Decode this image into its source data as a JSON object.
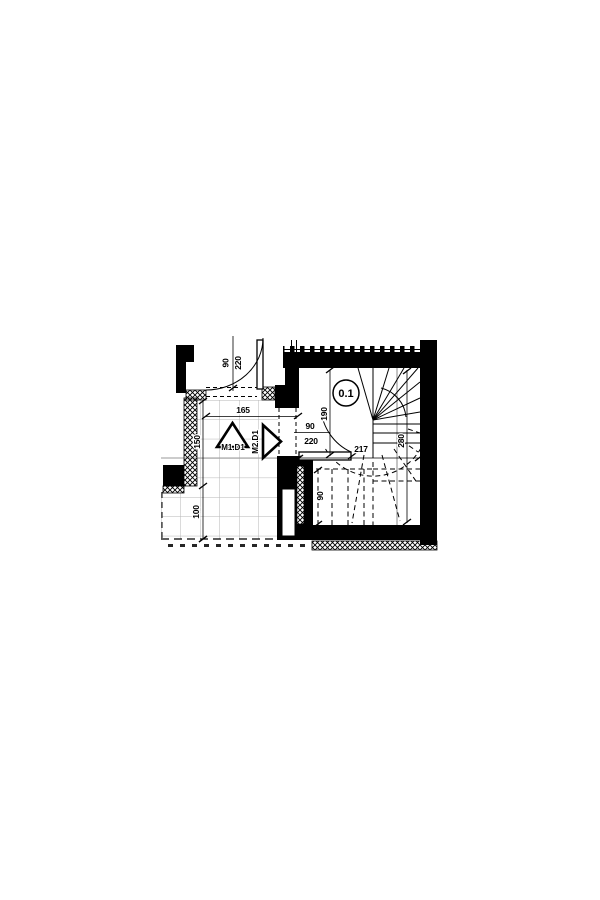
{
  "plan": {
    "room_label": "0.1",
    "doors": {
      "top": {
        "width": "90",
        "height": "220"
      },
      "stair": {
        "width": "90",
        "height": "220"
      }
    },
    "dims": {
      "hall_door_span": "165",
      "hall_upper": "150",
      "hall_lower": "100",
      "stair_depth": "217",
      "stair_height": "280",
      "entry_clear": "190",
      "flight_width": "90"
    },
    "markers": {
      "m1": "M1.D1",
      "m2": "M2.D1"
    },
    "colors": {
      "line": "#000000",
      "tile_grid": "#b5b5b5",
      "guide_line": "#8a8a8a",
      "background": "#ffffff"
    }
  }
}
